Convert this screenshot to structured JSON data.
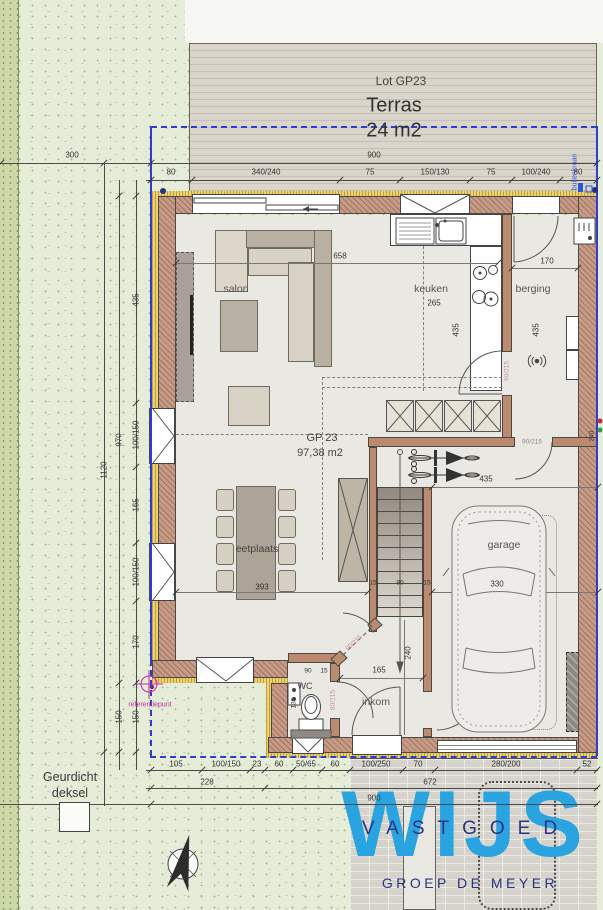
{
  "terrace": {
    "lot_label": "Lot GP23",
    "name": "Terras",
    "area": "24 m2"
  },
  "unit": {
    "code": "GP  23",
    "area": "97,38 m2"
  },
  "rooms": {
    "salon": "salon",
    "keuken": "keuken",
    "berging": "berging",
    "eetplaats": "eetplaats",
    "garage": "garage",
    "inkom": "inkom",
    "wc": "WC"
  },
  "appliances": {
    "dryer": "droogk.",
    "washer": "wasm."
  },
  "dims": {
    "site_left": "300",
    "top_total": "900",
    "top": [
      "80",
      "340/240",
      "75",
      "150/130",
      "75",
      "100/240",
      "80"
    ],
    "left_total": "1120",
    "left_building": "970",
    "left_front": "150",
    "left": [
      "435",
      "100/150",
      "165",
      "100/150",
      "170",
      "150"
    ],
    "bottom": [
      "105",
      "100/150",
      "23",
      "60",
      "50/65",
      "60",
      "100/250",
      "70",
      "280/200",
      "52"
    ],
    "bottom_sub": [
      "228",
      "672"
    ],
    "bottom_total": "900",
    "salon_width": "658",
    "keuken_island": "265",
    "keuken_depth": "435",
    "berging_width": "170",
    "berging_depth": "435",
    "table_length": "393",
    "stair": [
      "15",
      "90",
      "15"
    ],
    "garage_top": "435",
    "garage_width": "330",
    "hall_width": "165",
    "hall_depth": "240",
    "wc_width": "90",
    "wc_gap": "15",
    "wc_depth": "135",
    "right_wall": "240"
  },
  "doors": {
    "eetplaats": "90/215",
    "wc": "80/215",
    "keuken": "90/215",
    "garage": "90/215"
  },
  "notes": {
    "tap": "buitenkraan",
    "reference": "referentiepunt",
    "odor_line1": "Geurdicht",
    "odor_line2": "deksel"
  },
  "logo": {
    "wijs": "WIJS",
    "vastgoed": "VASTGOED",
    "groep": "GROEP DE MEYER"
  },
  "colors": {
    "boundary_blue": "#2f3cd4",
    "logo_blue": "#2aa4e1",
    "logo_navy": "#2b3480",
    "magenta": "#c22ba6",
    "wall_brick": "#c79c87",
    "insulation": "#ecd26f"
  }
}
